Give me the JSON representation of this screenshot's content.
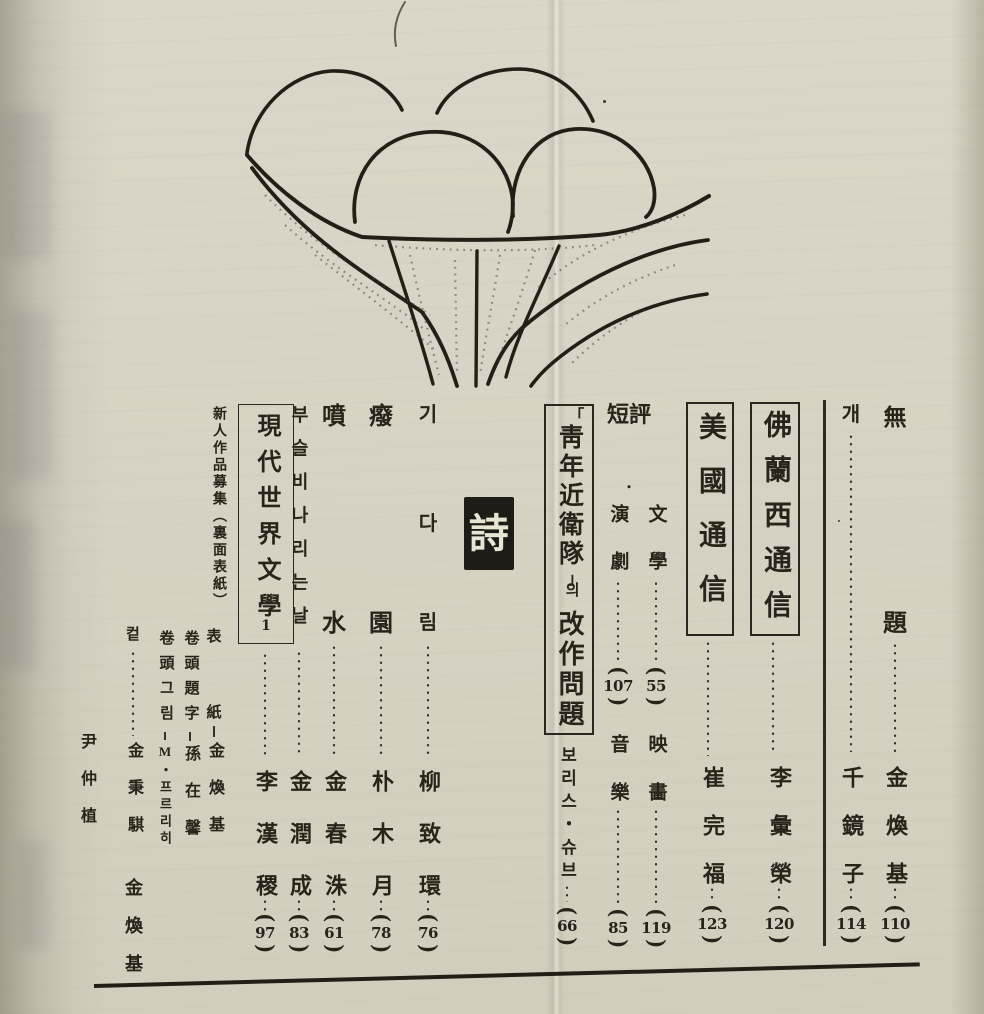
{
  "symbols": {
    "paren_open": "(",
    "paren_close": ")"
  },
  "poetry_section_label": "詩",
  "toc": {
    "mudae": {
      "title_char1": "無",
      "title_char2": "題",
      "author": "金煥基",
      "page": "110"
    },
    "gae": {
      "title": "개",
      "author": "千鏡子",
      "page": "114"
    },
    "france": {
      "title": "佛蘭西通信",
      "author": "李彙榮",
      "page": "120"
    },
    "usa": {
      "title": "美國通信",
      "author": "崔完福",
      "page": "123"
    },
    "danpyeong": {
      "heading": "短評",
      "bullet": "・",
      "literature": {
        "title": "文學",
        "page": "55"
      },
      "theatre": {
        "title": "演劇",
        "page": "107"
      },
      "film": {
        "title": "映畵",
        "page": "119"
      },
      "music": {
        "title": "音樂",
        "page": "85"
      }
    },
    "youth_guard": {
      "bracket_open": "「",
      "title": "靑年近衛隊",
      "bracket_close": "」",
      "particle": "의",
      "subtitle": "改作問題",
      "author": "보리스・슈브",
      "page": "66"
    },
    "gidarim": {
      "title_char1": "기",
      "title_char2": "다",
      "title_char3": "림",
      "author": "柳致環",
      "page": "76"
    },
    "pyewon": {
      "title_char1": "癈",
      "title_char2": "園",
      "author": "朴木月",
      "page": "78"
    },
    "bunsu": {
      "title_char1": "噴",
      "title_char2": "水",
      "author": "金春洙",
      "page": "61"
    },
    "buseulbi": {
      "title": "부슬비나리는날",
      "author": "金潤成",
      "page": "83"
    },
    "hyundai": {
      "title": "現代世界文學",
      "volume": "1",
      "author": "李漢稷",
      "page": "97"
    },
    "newcomer_notice": {
      "text": "新人作品募集（裏面表紙）"
    }
  },
  "credits": {
    "cover": {
      "label_char1": "表",
      "label_char2": "紙",
      "name": "金煥基"
    },
    "title_lettering": {
      "label": "卷頭題字",
      "name": "孫在馨"
    },
    "frontispiece_art": {
      "label": "卷頭그림",
      "name": "M・프르리히"
    },
    "cuts": {
      "label": "컽",
      "name1": "金秉騏",
      "name2": "金煥基",
      "name3": "尹仲植"
    }
  }
}
